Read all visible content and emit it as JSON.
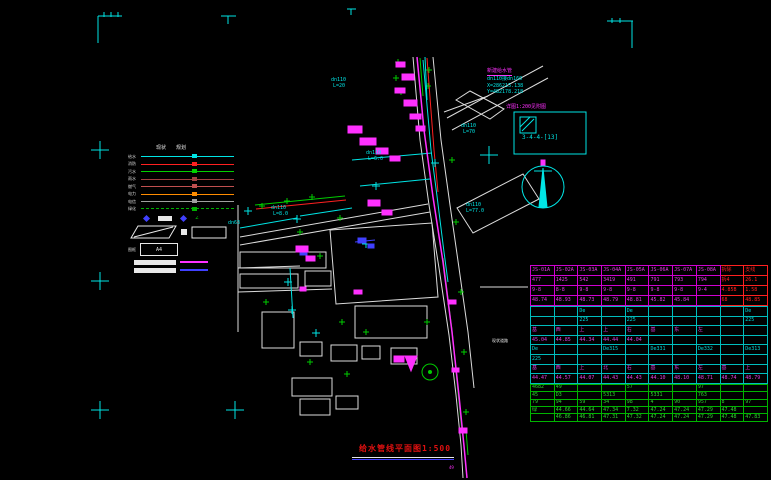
{
  "colors": {
    "cyan": "#00e5e5",
    "magenta": "#ff30ff",
    "red": "#ff2020",
    "green": "#00cc00",
    "white": "#e8e8e8",
    "blue": "#4040ff",
    "orange": "#ff8c00",
    "gray": "#9f9f9f"
  },
  "title": {
    "text": "给水管线平面图",
    "scale": "1:500"
  },
  "annotation": {
    "line1": "新建给水管",
    "line2": "dn110接dn160",
    "line3": "X=286215.138",
    "line4": "Y=482178.218"
  },
  "detail": {
    "note": "详图1:200见附图",
    "code": "3-4-4-[13]"
  },
  "legend": {
    "col1": "现状",
    "col2": "规划",
    "lines": [
      {
        "label": "给水",
        "color": "#00e5e5"
      },
      {
        "label": "消防",
        "color": "#ff2020"
      },
      {
        "label": "污水",
        "color": "#00d000"
      },
      {
        "label": "雨水",
        "color": "#a04040"
      },
      {
        "label": "燃气",
        "color": "#c05050"
      },
      {
        "label": "电力",
        "color": "#ff8c00"
      },
      {
        "label": "电信",
        "color": "#9f9f9f"
      },
      {
        "label": "绿化",
        "color": "#00b000",
        "dashed": true
      }
    ],
    "frame_label": "图框",
    "frame_size": "A4"
  },
  "map_labels": [
    {
      "t": "dn110",
      "x": 331,
      "y": 78,
      "c": "cyan"
    },
    {
      "t": "L=20",
      "x": 333,
      "y": 84,
      "c": "cyan"
    },
    {
      "t": "dn63",
      "x": 228,
      "y": 221,
      "c": "cyan"
    },
    {
      "t": "dn110",
      "x": 271,
      "y": 206,
      "c": "cyan"
    },
    {
      "t": "L=8.0",
      "x": 273,
      "y": 212,
      "c": "cyan"
    },
    {
      "t": "dn110",
      "x": 366,
      "y": 151,
      "c": "cyan"
    },
    {
      "t": "L=6.0",
      "x": 368,
      "y": 157,
      "c": "cyan"
    },
    {
      "t": "dn110",
      "x": 461,
      "y": 124,
      "c": "cyan"
    },
    {
      "t": "L=70",
      "x": 463,
      "y": 130,
      "c": "cyan"
    },
    {
      "t": "dn110",
      "x": 466,
      "y": 203,
      "c": "cyan"
    },
    {
      "t": "L=77.0",
      "x": 466,
      "y": 209,
      "c": "cyan"
    },
    {
      "t": "现状道路",
      "x": 492,
      "y": 339,
      "c": "white",
      "fs": 4
    },
    {
      "t": "49",
      "x": 449,
      "y": 466,
      "c": "magenta",
      "fs": 4
    }
  ],
  "table": {
    "columns": 10,
    "sections": [
      {
        "border": "#d000d0",
        "outer": "#ff0000",
        "row_h": 9,
        "text": "#e040e0",
        "alt_from": 8,
        "alt_color": "#ff2020",
        "rows": [
          {
            "cells": [
              "JS-01A",
              "JS-02A",
              "JS-03A",
              "JS-04A",
              "JS-05A",
              "JS-06A",
              "JS-07A",
              "JS-08A",
              "拆除",
              "支线"
            ]
          },
          {
            "cells": [
              "477",
              "1425",
              "542",
              "3419",
              "491",
              "791",
              "793",
              "794",
              "拆4",
              "26.1"
            ]
          },
          {
            "cells": [
              "9-8",
              "8-8",
              "9-8",
              "9-8",
              "9-8",
              "9-8",
              "9-8",
              "9-4",
              "4.85B",
              "1.58"
            ]
          },
          {
            "cells": [
              "48.74",
              "48.93",
              "48.73",
              "48.79",
              "48.81",
              "45.82",
              "45.84",
              "",
              "68",
              "48.85"
            ]
          }
        ]
      },
      {
        "border": "#00bdbd",
        "row_h": 8.6,
        "text": "#e040e0",
        "rows": [
          {
            "cells": [
              "",
              "",
              "De",
              "",
              "De",
              "",
              "",
              "",
              "",
              "De"
            ],
            "color": "#00d9d9"
          },
          {
            "cells": [
              "",
              "",
              "225",
              "",
              "225",
              "",
              "",
              "",
              "",
              "225"
            ],
            "color": "#00d9d9"
          },
          {
            "cells": [
              "基",
              "西",
              "上",
              "上",
              "右",
              "基",
              "东",
              "左",
              "",
              ""
            ]
          },
          {
            "cells": [
              "45.04",
              "44.85",
              "44.34",
              "44.44",
              "44.04",
              "",
              "",
              "",
              "",
              ""
            ]
          },
          {
            "cells": [
              "De",
              "",
              "",
              "De315",
              "",
              "De331",
              "",
              "De332",
              "",
              "De313"
            ],
            "color": "#00d9d9"
          },
          {
            "cells": [
              "225",
              "",
              "",
              "",
              "",
              "",
              "",
              "",
              "",
              ""
            ],
            "color": "#00d9d9"
          },
          {
            "cells": [
              "基",
              "西",
              "上",
              "北",
              "右",
              "基",
              "东",
              "左",
              "基",
              "上"
            ]
          },
          {
            "cells": [
              "44.47",
              "44.57",
              "44.07",
              "44.43",
              "44.43",
              "44.10",
              "48.10",
              "48.71",
              "48.74",
              "48.79"
            ]
          }
        ]
      },
      {
        "border": "#00b400",
        "row_h": 6.4,
        "text": "#30d030",
        "outer_bottom": "#ff0000",
        "rows": [
          {
            "cells": [
              "4682",
              "49",
              "",
              "",
              "57",
              "",
              "",
              "97",
              "",
              ""
            ]
          },
          {
            "cells": [
              "45",
              "D3",
              "",
              "5313",
              "",
              "5331",
              "",
              "763",
              "",
              ""
            ]
          },
          {
            "cells": [
              "79",
              "94",
              "59",
              "34",
              "98",
              "4",
              "90",
              "957",
              "8",
              "97"
            ]
          },
          {
            "cells": [
              "绿",
              "44.66",
              "44.64",
              "47.34",
              "7.32",
              "47.24",
              "47.24",
              "47.29",
              "47.48",
              ""
            ]
          },
          {
            "cells": [
              "",
              "46.86",
              "46.81",
              "47.31",
              "47.32",
              "47.24",
              "47.24",
              "47.29",
              "47.48",
              "47.83"
            ]
          }
        ]
      }
    ]
  }
}
